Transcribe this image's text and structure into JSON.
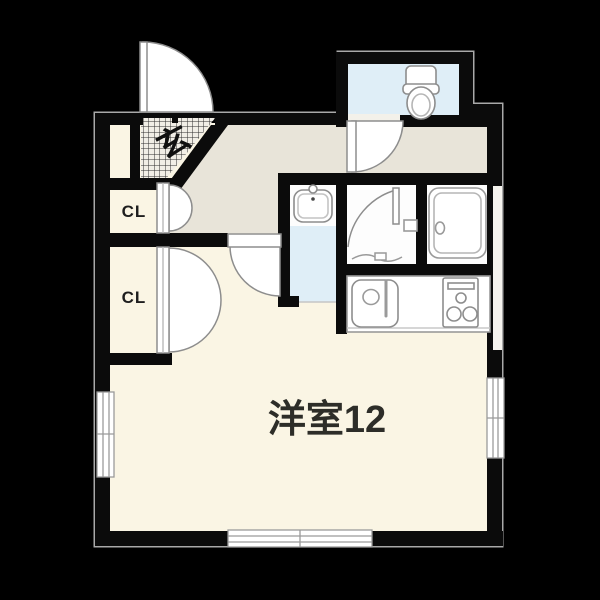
{
  "plan": {
    "type": "apartment-floor-plan",
    "labels": {
      "genkan": "玄",
      "closet_upper": "CL",
      "closet_lower": "CL",
      "main_room": "洋室12"
    },
    "rooms": [
      {
        "name": "genkan-entrance",
        "label": "玄"
      },
      {
        "name": "toilet-room",
        "label": ""
      },
      {
        "name": "washbasin-room",
        "label": ""
      },
      {
        "name": "bathroom",
        "label": ""
      },
      {
        "name": "bathtub-room",
        "label": ""
      },
      {
        "name": "kitchen-counter",
        "label": ""
      },
      {
        "name": "closet-upper",
        "label": "CL"
      },
      {
        "name": "closet-lower",
        "label": "CL"
      },
      {
        "name": "main-room",
        "label": "洋室12"
      }
    ],
    "icons": [
      "toilet-icon",
      "washbasin-icon",
      "bathtub-icon",
      "kitchen-sink-icon",
      "stove-icon",
      "door-swing-icon",
      "window-icon"
    ],
    "colors": {
      "background": "#000000",
      "wall": "#0b0b0b",
      "outer_outline": "#a9a9a9",
      "floor_main": "#faf5e4",
      "floor_hallway": "#e8e4d9",
      "floor_wet_blue": "#dfeef7",
      "floor_white": "#fdfdfd",
      "checker_base": "#f1eee6",
      "checker_line": "#2e2e2e",
      "door_stroke": "#8d8d8d",
      "icon_stroke": "#9a9a9a",
      "label_dark": "#2d2d28"
    }
  }
}
